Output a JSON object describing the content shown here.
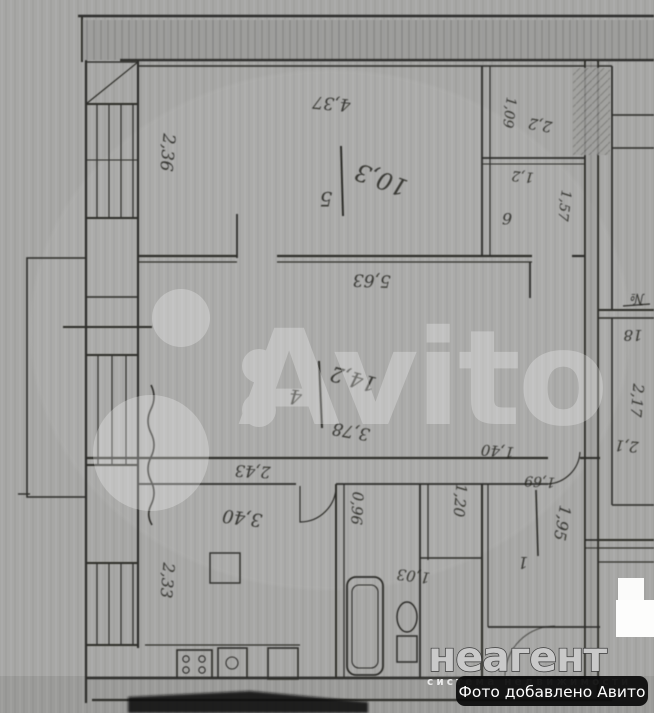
{
  "watermark": {
    "wordmark": "Avito"
  },
  "branding": {
    "logo": "неагент",
    "tagline": "система недвижимости",
    "caption": "Фото добавлено Авито"
  },
  "plan": {
    "rooms": {
      "room5": {
        "number": "5",
        "area": "10,3"
      },
      "room4": {
        "number": "4",
        "area": "14,2",
        "inner": "3,78"
      },
      "room1": {
        "number": "1",
        "area": "1,95"
      },
      "room6": {
        "number": "6"
      }
    },
    "dims": {
      "d236": "2,36",
      "d437": "4,37",
      "d563": "5,63",
      "d243": "2,43",
      "d340": "3,40",
      "d233": "2,33",
      "d096": "0,96",
      "d140": "1,40",
      "d120": "1,20",
      "d169": "1,69",
      "d103": "1,03",
      "d21": "2,1",
      "d217": "2,17",
      "d109": "1,09",
      "d22": "2,2",
      "d12": "1,2",
      "d157": "1,57"
    },
    "apartment": {
      "no_sign": "№",
      "number": "18"
    }
  }
}
